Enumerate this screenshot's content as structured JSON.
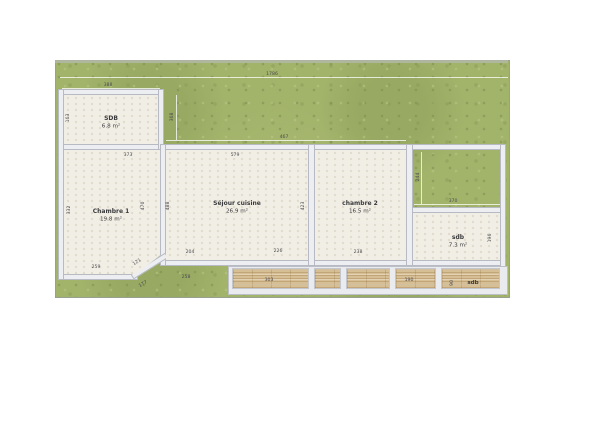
{
  "plan": {
    "type": "floor-plan",
    "units": "m²"
  },
  "colors": {
    "grass": "#a2b36a",
    "floor": "#f1eee5",
    "wall": "#eceef2",
    "wood": "#d7bf95",
    "dim_text": "#4c4c50"
  },
  "rooms": [
    {
      "name": "SDB",
      "area": "6.8 m²"
    },
    {
      "name": "Chambre 1",
      "area": "19.8 m²"
    },
    {
      "name": "Séjour cuisine",
      "area": "26.9 m²"
    },
    {
      "name": "chambre 2",
      "area": "16.5 m²"
    },
    {
      "name": "sdb",
      "area": "7.3 m²"
    }
  ],
  "deck": {
    "label": "sdb"
  },
  "dimensions": [
    {
      "text": "1786",
      "x": 272,
      "y": 74,
      "rot": 0
    },
    {
      "text": "388",
      "x": 108,
      "y": 85,
      "rot": 0
    },
    {
      "text": "163",
      "x": 68,
      "y": 118,
      "rot": -90
    },
    {
      "text": "368",
      "x": 172,
      "y": 117,
      "rot": -90
    },
    {
      "text": "467",
      "x": 284,
      "y": 137,
      "rot": 0
    },
    {
      "text": "373",
      "x": 128,
      "y": 155,
      "rot": 0
    },
    {
      "text": "579",
      "x": 235,
      "y": 155,
      "rot": 0
    },
    {
      "text": "332",
      "x": 69,
      "y": 210,
      "rot": -90
    },
    {
      "text": "470",
      "x": 143,
      "y": 206,
      "rot": -90
    },
    {
      "text": "488",
      "x": 168,
      "y": 206,
      "rot": -90
    },
    {
      "text": "423",
      "x": 303,
      "y": 206,
      "rot": -90
    },
    {
      "text": "244",
      "x": 418,
      "y": 177,
      "rot": -90
    },
    {
      "text": "370",
      "x": 453,
      "y": 201,
      "rot": 0
    },
    {
      "text": "196",
      "x": 490,
      "y": 238,
      "rot": -90
    },
    {
      "text": "259",
      "x": 96,
      "y": 267,
      "rot": 0
    },
    {
      "text": "121",
      "x": 137,
      "y": 262,
      "rot": -33
    },
    {
      "text": "204",
      "x": 190,
      "y": 252,
      "rot": 0
    },
    {
      "text": "226",
      "x": 278,
      "y": 251,
      "rot": 0
    },
    {
      "text": "238",
      "x": 358,
      "y": 252,
      "rot": 0
    },
    {
      "text": "258",
      "x": 186,
      "y": 277,
      "rot": 0
    },
    {
      "text": "177",
      "x": 143,
      "y": 284,
      "rot": -30
    },
    {
      "text": "303",
      "x": 269,
      "y": 280,
      "rot": 0
    },
    {
      "text": "190",
      "x": 409,
      "y": 280,
      "rot": 0
    },
    {
      "text": "90",
      "x": 452,
      "y": 283,
      "rot": -90
    }
  ]
}
